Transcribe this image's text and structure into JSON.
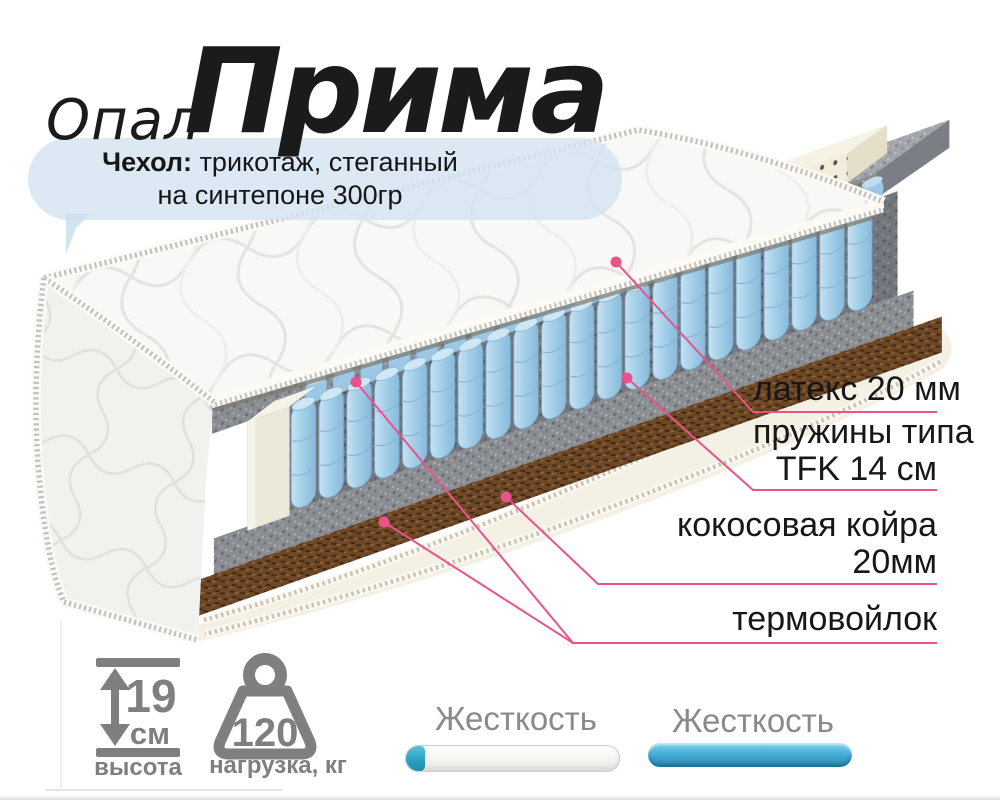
{
  "title": {
    "prefix": "Опал",
    "name": "Прима"
  },
  "bubble": {
    "bold": "Чехол:",
    "rest": " трикотаж, стеганный",
    "line2": "на синтепоне 300гр"
  },
  "labels": {
    "latex": {
      "text": "латекс 20 мм"
    },
    "springs": {
      "line1": "пружины типа",
      "line2": "TFK 14 см"
    },
    "coir": {
      "line1": "кокосовая койра",
      "line2": "20мм"
    },
    "felt": {
      "text": "термовойлок"
    }
  },
  "specs": {
    "height": {
      "value": "19",
      "unit": "см",
      "caption": "высота"
    },
    "load": {
      "value": "120",
      "caption": "нагрузка, кг"
    }
  },
  "hardness": {
    "left": {
      "label": "Жесткость",
      "fill_percent": 9
    },
    "right": {
      "label": "Жесткость",
      "fill_percent": 100
    }
  },
  "icons": [
    "height-arrow-icon",
    "weight-icon",
    "speech-bubble",
    "leader-dot"
  ],
  "colors": {
    "accent_pink": "#e8548a",
    "slider_blue": "#3fa9d4",
    "icon_gray": "#7f7f7f",
    "bubble_blue": "#d4e4f3",
    "spring_blue": "#a4cfe8",
    "coir_brown": "#6d4827",
    "felt_gray": "#8e9196",
    "latex_cream": "#f2edda",
    "title_black": "#1b1b1b"
  }
}
